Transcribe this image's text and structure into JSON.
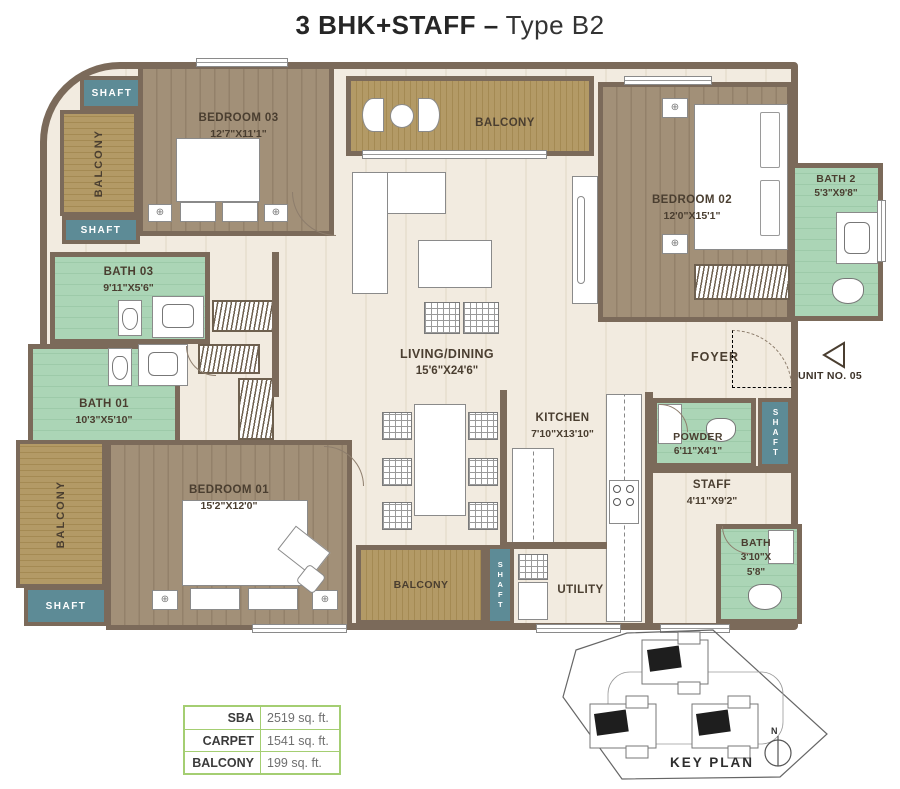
{
  "title": {
    "bold": "3 BHK+STAFF –",
    "regular": "Type B2"
  },
  "labels": {
    "shaft": "SHAFT",
    "balcony": "BALCONY",
    "foyer": "FOYER",
    "utility": "UTILITY"
  },
  "unit_label": "UNIT NO. 05",
  "rooms": {
    "bedroom03": {
      "name": "BEDROOM 03",
      "dims": "12'7\"X11'1\""
    },
    "bedroom02": {
      "name": "BEDROOM 02",
      "dims": "12'0\"X15'1\""
    },
    "bedroom01": {
      "name": "BEDROOM 01",
      "dims": "15'2\"X12'0\""
    },
    "bath2": {
      "name": "BATH 2",
      "dims": "5'3\"X9'8\""
    },
    "bath03": {
      "name": "BATH 03",
      "dims": "9'11\"X5'6\""
    },
    "bath01": {
      "name": "BATH 01",
      "dims": "10'3\"X5'10\""
    },
    "living": {
      "name": "LIVING/DINING",
      "dims": "15'6\"X24'6\""
    },
    "kitchen": {
      "name": "KITCHEN",
      "dims": "7'10\"X13'10\""
    },
    "powder": {
      "name": "POWDER",
      "dims": "6'11\"X4'1\""
    },
    "staff": {
      "name": "STAFF",
      "dims": "4'11\"X9'2\""
    },
    "staffbath": {
      "name": "BATH",
      "dims_line1": "3'10\"X",
      "dims_line2": "5'8\""
    }
  },
  "area_table": {
    "rows": [
      {
        "label": "SBA",
        "value": "2519 sq. ft."
      },
      {
        "label": "CARPET",
        "value": "1541 sq. ft."
      },
      {
        "label": "BALCONY",
        "value": "199 sq. ft."
      }
    ]
  },
  "key_plan": {
    "label": "KEY PLAN",
    "north": "N"
  },
  "icons": {
    "nightstand": "⊕"
  },
  "colors": {
    "wall": "#7b6a5a",
    "wood_deck": "#b39a66",
    "wood_floor": "#a29078",
    "bath_green": "#abd5b6",
    "shaft_teal": "#5d8b96",
    "floor_cream": "#f2ebe0",
    "table_border_green": "#a4ce72"
  }
}
